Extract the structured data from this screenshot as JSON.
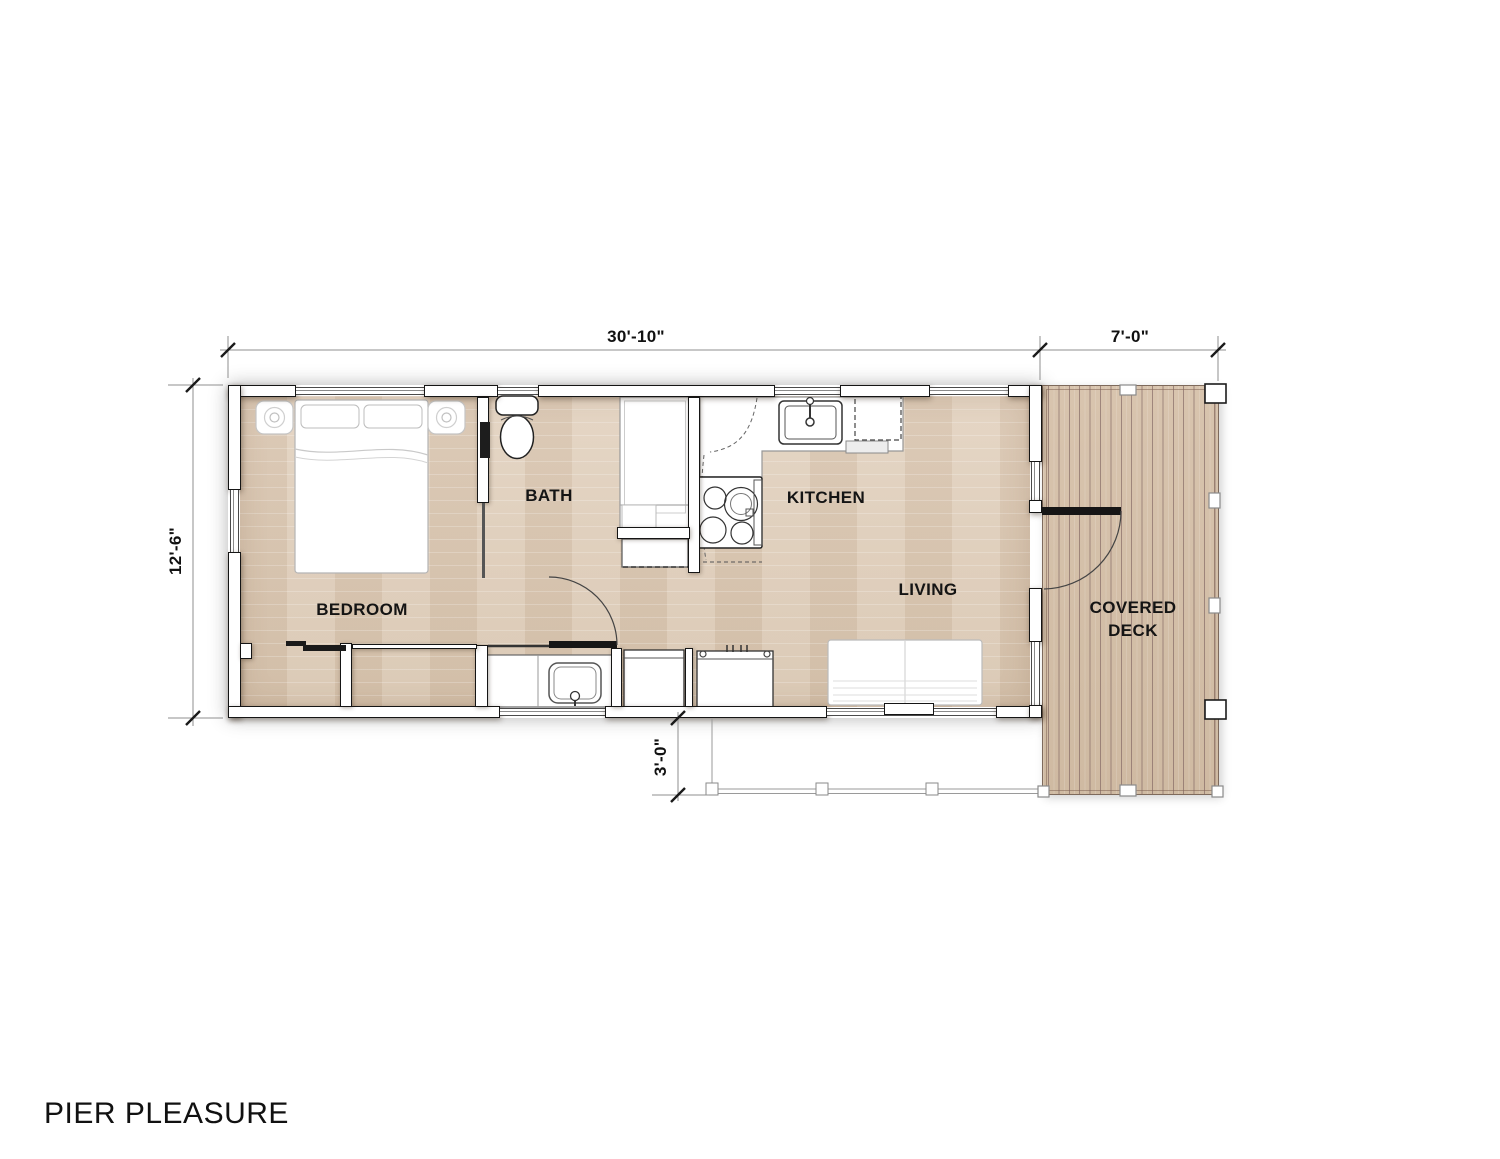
{
  "title": "PIER PLEASURE",
  "plan": {
    "rooms": [
      {
        "id": "bedroom",
        "label": "BEDROOM"
      },
      {
        "id": "bath",
        "label": "BATH"
      },
      {
        "id": "kitchen",
        "label": "KITCHEN"
      },
      {
        "id": "living",
        "label": "LIVING"
      },
      {
        "id": "covered_deck",
        "label": "COVERED DECK"
      }
    ],
    "dimensions": {
      "overall_width": "30'-10\"",
      "deck_width": "7'-0\"",
      "overall_depth": "12'-6\"",
      "walkway_depth": "3'-0\""
    },
    "fixtures": [
      "bed",
      "pillows",
      "nightstands",
      "sliding-closet-doors",
      "toilet",
      "shower",
      "linen-closet",
      "vanity-sink",
      "kitchen-sink",
      "range",
      "refrigerator-dashed",
      "washer",
      "appliance",
      "sofa",
      "bath-door",
      "deck-door",
      "deck-posts",
      "walkway-posts"
    ],
    "colors": {
      "background": "#ffffff",
      "floor_wood": "#dccab6",
      "deck_wood": "#d4bfa8",
      "wall_fill": "#ffffff",
      "wall_outline": "#151515",
      "dimension_line": "#8f8f8f",
      "text": "#141414"
    }
  }
}
